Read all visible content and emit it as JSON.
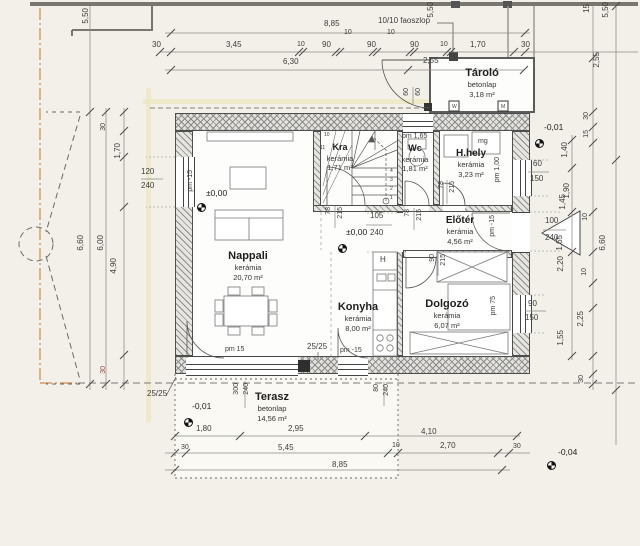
{
  "meta": {
    "drawing_type": "ground floor plan"
  },
  "colors": {
    "background": "#f2f0e8",
    "paper": "#fdfdfb",
    "wall_line": "#4e4e4e",
    "dim_text": "#3d3d3d",
    "property_line_orange": "#cf8a50",
    "section_yellow": "#ebe7c0",
    "red_dim": "#9b4a42"
  },
  "rooms": [
    {
      "name": "Nappali",
      "material": "kerámia",
      "area": "20,70 m²",
      "cx": 248,
      "top": 249
    },
    {
      "name": "Konyha",
      "material": "kerámia",
      "area": "8,00 m²",
      "cx": 358,
      "top": 300
    },
    {
      "name": "Dolgozó",
      "material": "kerámia",
      "area": "6,07 m²",
      "cx": 447,
      "top": 297
    },
    {
      "name": "Előtér",
      "material": "kerámia",
      "area": "4,56 m²",
      "cx": 460,
      "top": 214,
      "nf": 10
    },
    {
      "name": "H.hely",
      "material": "kerámia",
      "area": "3,23 m²",
      "cx": 471,
      "top": 147,
      "nf": 10
    },
    {
      "name": "Wc",
      "material": "kerámia",
      "area": "1,81 m²",
      "cx": 415,
      "top": 143,
      "nf": 9
    },
    {
      "name": "Kra",
      "material": "kerámia",
      "area": "1,71 m²",
      "cx": 340,
      "top": 142,
      "nf": 9
    },
    {
      "name": "Tároló",
      "material": "betonlap",
      "area": "3,18 m²",
      "cx": 482,
      "top": 66
    },
    {
      "name": "Terasz",
      "material": "betonlap",
      "area": "14,56 m²",
      "cx": 272,
      "top": 390
    }
  ],
  "levels": [
    {
      "t": "±0,00",
      "lx": 206,
      "ly": 189,
      "mx": 197,
      "my": 203
    },
    {
      "t": "±0,00",
      "lx": 346,
      "ly": 228,
      "mx": 338,
      "my": 244
    },
    {
      "t": "-0,01",
      "lx": 544,
      "ly": 123,
      "mx": 535,
      "my": 139
    },
    {
      "t": "-0,01",
      "lx": 192,
      "ly": 402,
      "mx": 184,
      "my": 418
    },
    {
      "t": "-0,04",
      "lx": 558,
      "ly": 448,
      "mx": 547,
      "my": 461
    }
  ],
  "dims": [
    {
      "t": "5,50",
      "x": 82,
      "y": 8,
      "r": 1
    },
    {
      "t": "8,85",
      "x": 324,
      "y": 20
    },
    {
      "t": "10/10 faoszlop",
      "x": 378,
      "y": 17
    },
    {
      "t": "10",
      "x": 344,
      "y": 29,
      "s": 7
    },
    {
      "t": "10",
      "x": 387,
      "y": 29,
      "s": 7
    },
    {
      "t": "30",
      "x": 152,
      "y": 41
    },
    {
      "t": "3,45",
      "x": 226,
      "y": 41
    },
    {
      "t": "10",
      "x": 297,
      "y": 41,
      "s": 7
    },
    {
      "t": "90",
      "x": 322,
      "y": 41
    },
    {
      "t": "90",
      "x": 367,
      "y": 41
    },
    {
      "t": "90",
      "x": 410,
      "y": 41
    },
    {
      "t": "10",
      "x": 440,
      "y": 41,
      "s": 7
    },
    {
      "t": "1,70",
      "x": 470,
      "y": 41
    },
    {
      "t": "30",
      "x": 521,
      "y": 41
    },
    {
      "t": "6,30",
      "x": 283,
      "y": 58
    },
    {
      "t": "2,55",
      "x": 423,
      "y": 57
    },
    {
      "t": "5,50",
      "x": 427,
      "y": 2,
      "r": 1
    },
    {
      "t": "15",
      "x": 583,
      "y": 4,
      "r": 1
    },
    {
      "t": "5,50",
      "x": 602,
      "y": 2,
      "r": 1
    },
    {
      "t": "2,55",
      "x": 593,
      "y": 52,
      "r": 1
    },
    {
      "t": "60",
      "x": 403,
      "y": 88,
      "r": 1,
      "s": 7
    },
    {
      "t": "60",
      "x": 415,
      "y": 88,
      "r": 1,
      "s": 7
    },
    {
      "t": "W",
      "x": 452,
      "y": 105,
      "s": 5
    },
    {
      "t": "M",
      "x": 501,
      "y": 105,
      "s": 5
    },
    {
      "t": "30",
      "x": 583,
      "y": 112,
      "r": 1,
      "s": 7
    },
    {
      "t": "15",
      "x": 583,
      "y": 130,
      "r": 1,
      "s": 7
    },
    {
      "t": "1,40",
      "x": 561,
      "y": 142,
      "r": 1
    },
    {
      "t": "1,90",
      "x": 563,
      "y": 183,
      "r": 1
    },
    {
      "t": "30",
      "x": 100,
      "y": 123,
      "r": 1,
      "s": 7
    },
    {
      "t": "1,70",
      "x": 114,
      "y": 143,
      "r": 1
    },
    {
      "t": "120",
      "x": 141,
      "y": 168
    },
    {
      "t": "240",
      "x": 141,
      "y": 182
    },
    {
      "t": "pm -15",
      "x": 187,
      "y": 170,
      "r": 1,
      "s": 7
    },
    {
      "t": "6,60",
      "x": 77,
      "y": 235,
      "r": 1
    },
    {
      "t": "6,00",
      "x": 97,
      "y": 235,
      "r": 1
    },
    {
      "t": "4,90",
      "x": 110,
      "y": 258,
      "r": 1
    },
    {
      "t": "30",
      "x": 100,
      "y": 366,
      "r": 1,
      "s": 7,
      "c": "#9b4a42"
    },
    {
      "t": "25/25",
      "x": 147,
      "y": 390
    },
    {
      "t": "pm 1,65",
      "x": 402,
      "y": 133,
      "s": 7
    },
    {
      "t": "mg",
      "x": 478,
      "y": 138,
      "s": 7
    },
    {
      "t": "pm 1,00",
      "x": 494,
      "y": 157,
      "r": 1,
      "s": 7
    },
    {
      "t": "60",
      "x": 533,
      "y": 160
    },
    {
      "t": "150",
      "x": 530,
      "y": 175
    },
    {
      "t": "78",
      "x": 325,
      "y": 207,
      "r": 1,
      "s": 7
    },
    {
      "t": "215",
      "x": 337,
      "y": 207,
      "r": 1,
      "s": 7
    },
    {
      "t": "78",
      "x": 404,
      "y": 209,
      "r": 1,
      "s": 7
    },
    {
      "t": "215",
      "x": 416,
      "y": 209,
      "r": 1,
      "s": 7
    },
    {
      "t": "78",
      "x": 438,
      "y": 181,
      "r": 1,
      "s": 7
    },
    {
      "t": "215",
      "x": 449,
      "y": 181,
      "r": 1,
      "s": 7
    },
    {
      "t": "105",
      "x": 370,
      "y": 212
    },
    {
      "t": "240",
      "x": 370,
      "y": 229
    },
    {
      "t": "pm -15",
      "x": 489,
      "y": 215,
      "r": 1,
      "s": 7
    },
    {
      "t": "100",
      "x": 545,
      "y": 217
    },
    {
      "t": "240",
      "x": 545,
      "y": 234
    },
    {
      "t": "1,45",
      "x": 559,
      "y": 194,
      "r": 1
    },
    {
      "t": "10",
      "x": 582,
      "y": 213,
      "r": 1,
      "s": 7
    },
    {
      "t": "1,65",
      "x": 556,
      "y": 235,
      "r": 1
    },
    {
      "t": "2,20",
      "x": 557,
      "y": 256,
      "r": 1
    },
    {
      "t": "10",
      "x": 581,
      "y": 268,
      "r": 1,
      "s": 7
    },
    {
      "t": "6,60",
      "x": 599,
      "y": 235,
      "r": 1
    },
    {
      "t": "H",
      "x": 380,
      "y": 256,
      "s": 8
    },
    {
      "t": "90",
      "x": 429,
      "y": 254,
      "r": 1,
      "s": 7
    },
    {
      "t": "215",
      "x": 440,
      "y": 254,
      "r": 1,
      "s": 7
    },
    {
      "t": "pm 75",
      "x": 490,
      "y": 296,
      "r": 1,
      "s": 7
    },
    {
      "t": "90",
      "x": 528,
      "y": 300
    },
    {
      "t": "150",
      "x": 525,
      "y": 314
    },
    {
      "t": "2,25",
      "x": 577,
      "y": 311,
      "r": 1
    },
    {
      "t": "1,55",
      "x": 557,
      "y": 330,
      "r": 1
    },
    {
      "t": "30",
      "x": 578,
      "y": 375,
      "r": 1,
      "s": 7
    },
    {
      "t": "pm 15",
      "x": 225,
      "y": 346,
      "s": 7
    },
    {
      "t": "25/25",
      "x": 307,
      "y": 343
    },
    {
      "t": "pm -15",
      "x": 340,
      "y": 347,
      "s": 7
    },
    {
      "t": "300",
      "x": 233,
      "y": 383,
      "r": 1,
      "s": 7
    },
    {
      "t": "240",
      "x": 243,
      "y": 383,
      "r": 1,
      "s": 7
    },
    {
      "t": "80",
      "x": 373,
      "y": 384,
      "r": 1,
      "s": 7
    },
    {
      "t": "240",
      "x": 383,
      "y": 384,
      "r": 1,
      "s": 7
    },
    {
      "t": "1,80",
      "x": 196,
      "y": 425
    },
    {
      "t": "2,95",
      "x": 288,
      "y": 425
    },
    {
      "t": "4,10",
      "x": 421,
      "y": 428
    },
    {
      "t": "30",
      "x": 181,
      "y": 444,
      "s": 7
    },
    {
      "t": "5,45",
      "x": 278,
      "y": 444
    },
    {
      "t": "10",
      "x": 392,
      "y": 442,
      "s": 7
    },
    {
      "t": "2,70",
      "x": 440,
      "y": 442
    },
    {
      "t": "30",
      "x": 513,
      "y": 443,
      "s": 7
    },
    {
      "t": "8,85",
      "x": 332,
      "y": 461
    },
    {
      "t": "1",
      "x": 390,
      "y": 196,
      "s": 5
    },
    {
      "t": "2",
      "x": 390,
      "y": 187,
      "s": 5
    },
    {
      "t": "3",
      "x": 390,
      "y": 178,
      "s": 5
    },
    {
      "t": "4",
      "x": 390,
      "y": 169,
      "s": 5
    },
    {
      "t": "10",
      "x": 324,
      "y": 133,
      "s": 5
    },
    {
      "t": "11",
      "x": 320,
      "y": 146,
      "s": 5
    }
  ]
}
